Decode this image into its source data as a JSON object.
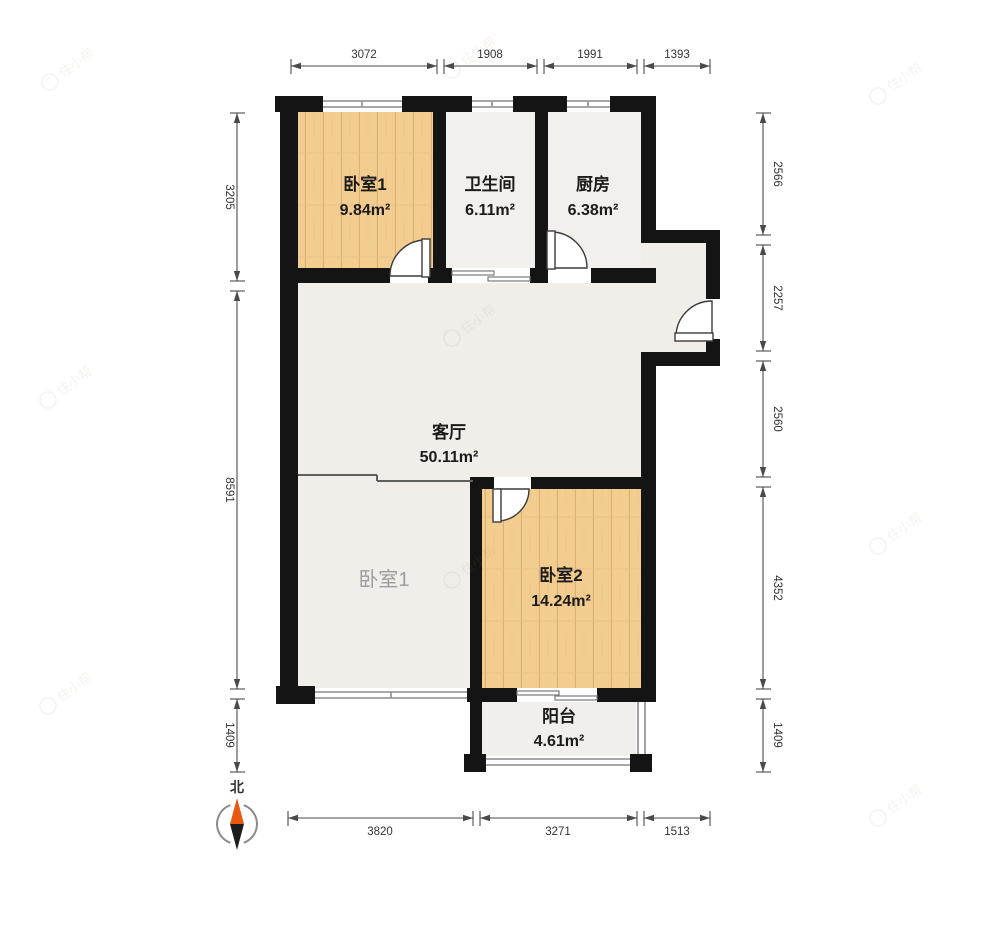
{
  "floorplan": {
    "rooms": {
      "bedroom1_top": {
        "name": "卧室1",
        "area": "9.84m²"
      },
      "bathroom": {
        "name": "卫生间",
        "area": "6.11m²"
      },
      "kitchen": {
        "name": "厨房",
        "area": "6.38m²"
      },
      "living": {
        "name": "客厅",
        "area": "50.11m²"
      },
      "bedroom1_lower": {
        "name": "卧室1"
      },
      "bedroom2": {
        "name": "卧室2",
        "area": "14.24m²"
      },
      "balcony": {
        "name": "阳台",
        "area": "4.61m²"
      }
    },
    "dimensions": {
      "top": [
        "3072",
        "1908",
        "1991",
        "1393"
      ],
      "left": [
        "3205",
        "8591",
        "1409"
      ],
      "right": [
        "2566",
        "2257",
        "2560",
        "4352",
        "1409"
      ],
      "bottom": [
        "3820",
        "3271",
        "1513"
      ]
    },
    "compass": {
      "label": "北"
    },
    "watermark": {
      "text": "住小帮"
    },
    "colors": {
      "wall": "#141414",
      "wood_floor": "#f3cd90",
      "tile_floor": "#f2f0ec",
      "compass_orange": "#e8590f"
    }
  }
}
